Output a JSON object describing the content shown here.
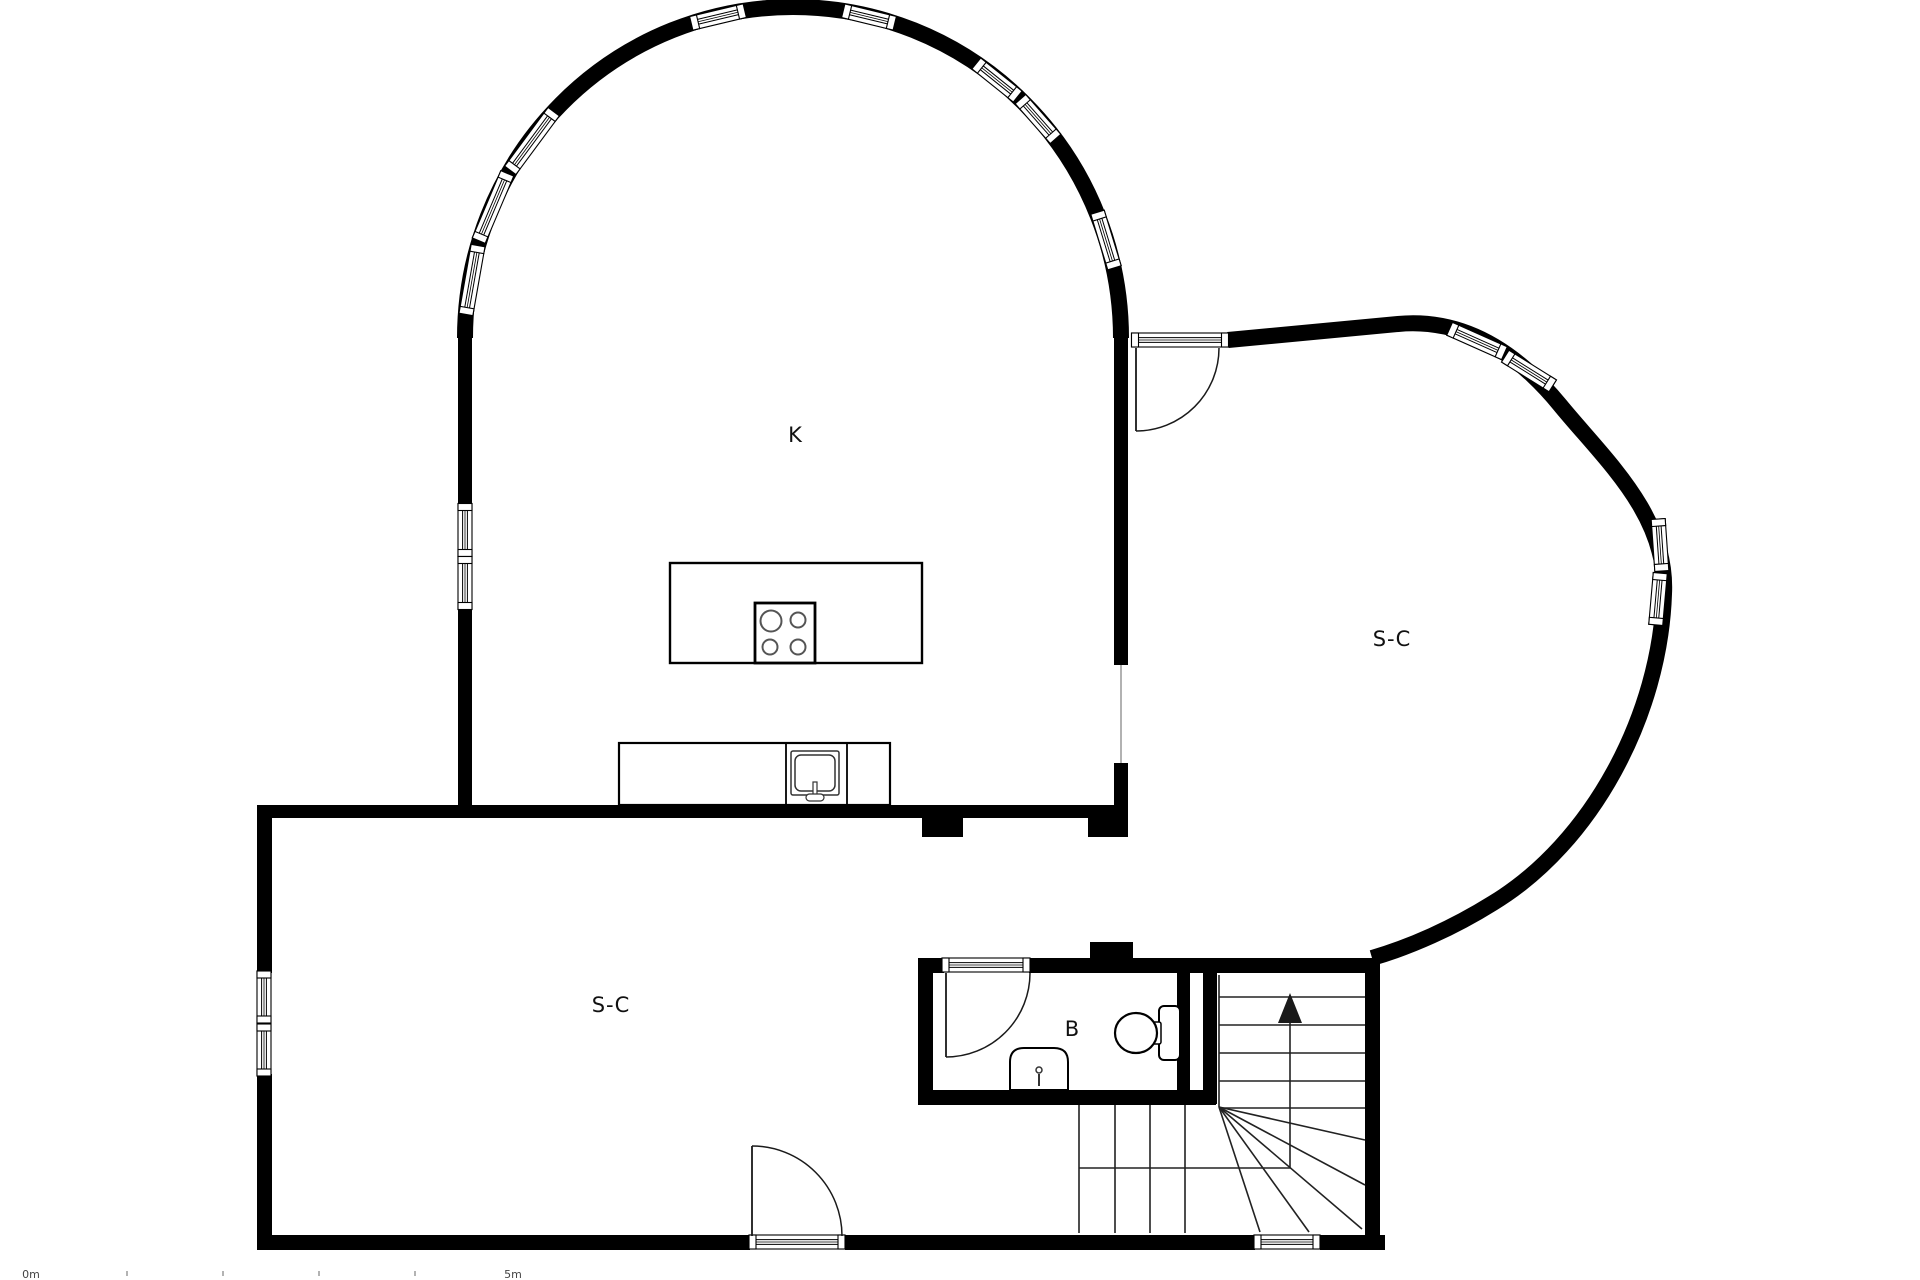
{
  "page": {
    "type": "architectural-floor-plan",
    "background": "#ffffff",
    "ink": "#000000"
  },
  "rooms": [
    {
      "id": "kitchen",
      "label": "K",
      "x": 795,
      "y": 442
    },
    {
      "id": "living-right",
      "label": "S-C",
      "x": 1392,
      "y": 646
    },
    {
      "id": "living-lower",
      "label": "S-C",
      "x": 611,
      "y": 1012
    },
    {
      "id": "bathroom",
      "label": "B",
      "x": 1072,
      "y": 1036
    }
  ],
  "scalebar": {
    "start_label": "0m",
    "end_label": "5m",
    "start_x": 31,
    "end_x": 513,
    "label_y": 1278,
    "tick_xs": [
      126,
      222,
      318,
      414
    ],
    "tick_y": 1271
  },
  "plan": {
    "colors": {
      "wall": "#000000",
      "line": "#1a1a1a",
      "stair": "#222222",
      "light": "#9e9e9e",
      "tick": "#b3b3b3"
    },
    "elements": [
      {
        "t": "path",
        "n": "arch-wall",
        "d": "M 465 338 A 328 331 0 0 1 1121 338",
        "stroke": "#000000",
        "sw": 16,
        "fill": "none"
      },
      {
        "t": "path",
        "n": "sc-curved-wall",
        "d": "M 1228 340 L 1398 324 C 1462 318 1515 350 1560 405 C 1605 460 1668 515 1664 594 C 1660 715 1592 843 1493 903 C 1453 928 1410 947 1372 958",
        "stroke": "#000000",
        "sw": 16,
        "fill": "none"
      },
      {
        "t": "rect",
        "n": "wall-kitchen-bottom",
        "x": 257,
        "y": 805,
        "w": 871,
        "h": 13,
        "fill": "#000000"
      },
      {
        "t": "rect",
        "n": "wall-stub-left",
        "x": 922,
        "y": 818,
        "w": 41,
        "h": 19,
        "fill": "#000000"
      },
      {
        "t": "rect",
        "n": "wall-stub-right",
        "x": 1088,
        "y": 818,
        "w": 40,
        "h": 19,
        "fill": "#000000"
      },
      {
        "t": "rect",
        "n": "wall-k-left-upper",
        "x": 458,
        "y": 331,
        "w": 14,
        "h": 174,
        "fill": "#000000"
      },
      {
        "t": "rect",
        "n": "wall-k-left-lower",
        "x": 458,
        "y": 607,
        "w": 14,
        "h": 211,
        "fill": "#000000"
      },
      {
        "t": "rect",
        "n": "wall-k-right-upper",
        "x": 1114,
        "y": 324,
        "w": 14,
        "h": 341,
        "fill": "#000000"
      },
      {
        "t": "rect",
        "n": "wall-k-right-lower",
        "x": 1114,
        "y": 763,
        "w": 14,
        "h": 74,
        "fill": "#000000"
      },
      {
        "t": "rect",
        "n": "wall-left-upper",
        "x": 257,
        "y": 805,
        "w": 15,
        "h": 168,
        "fill": "#000000"
      },
      {
        "t": "rect",
        "n": "wall-left-lower",
        "x": 257,
        "y": 1074,
        "w": 15,
        "h": 176,
        "fill": "#000000"
      },
      {
        "t": "rect",
        "n": "wall-bottom-a",
        "x": 257,
        "y": 1235,
        "w": 493,
        "h": 15,
        "fill": "#000000"
      },
      {
        "t": "rect",
        "n": "wall-bottom-b",
        "x": 845,
        "y": 1235,
        "w": 410,
        "h": 15,
        "fill": "#000000"
      },
      {
        "t": "rect",
        "n": "wall-bottom-c",
        "x": 1320,
        "y": 1235,
        "w": 65,
        "h": 15,
        "fill": "#000000"
      },
      {
        "t": "rect",
        "n": "wall-bath-top-left",
        "x": 918,
        "y": 958,
        "w": 26,
        "h": 15,
        "fill": "#000000"
      },
      {
        "t": "rect",
        "n": "wall-bath-top-right",
        "x": 1029,
        "y": 958,
        "w": 351,
        "h": 15,
        "fill": "#000000"
      },
      {
        "t": "rect",
        "n": "wall-bath-stub-above",
        "x": 1090,
        "y": 942,
        "w": 43,
        "h": 16,
        "fill": "#000000"
      },
      {
        "t": "rect",
        "n": "wall-bath-left",
        "x": 918,
        "y": 958,
        "w": 15,
        "h": 147,
        "fill": "#000000"
      },
      {
        "t": "rect",
        "n": "wall-bath-right",
        "x": 1177,
        "y": 958,
        "w": 13,
        "h": 147,
        "fill": "#000000"
      },
      {
        "t": "rect",
        "n": "wall-stair-left",
        "x": 1203,
        "y": 973,
        "w": 14,
        "h": 131,
        "fill": "#000000"
      },
      {
        "t": "rect",
        "n": "wall-bath-bottom",
        "x": 918,
        "y": 1090,
        "w": 298,
        "h": 15,
        "fill": "#000000"
      },
      {
        "t": "rect",
        "n": "wall-stair-right",
        "x": 1365,
        "y": 958,
        "w": 15,
        "h": 292,
        "fill": "#000000"
      },
      {
        "t": "line",
        "n": "room-opening-line",
        "x1": 1121,
        "y1": 665,
        "x2": 1121,
        "y2": 763,
        "stroke": "#9e9e9e",
        "sw": 1.6
      },
      {
        "t": "win",
        "n": "window-arch-1",
        "cx": 472,
        "cy": 280,
        "len": 70,
        "rot": 100
      },
      {
        "t": "win",
        "n": "window-arch-2",
        "cx": 493,
        "cy": 207,
        "len": 73,
        "rot": 113
      },
      {
        "t": "win",
        "n": "window-arch-3",
        "cx": 532,
        "cy": 141,
        "len": 73,
        "rot": 126.5
      },
      {
        "t": "win",
        "n": "window-arch-4",
        "cx": 718,
        "cy": 17,
        "len": 55,
        "rot": 166.6
      },
      {
        "t": "win",
        "n": "window-arch-5",
        "cx": 869,
        "cy": 17,
        "len": 53,
        "rot": 13.6
      },
      {
        "t": "win",
        "n": "window-arch-6",
        "cx": 997,
        "cy": 80,
        "len": 53,
        "rot": 38.7
      },
      {
        "t": "win",
        "n": "window-arch-7",
        "cx": 1038,
        "cy": 119,
        "len": 53,
        "rot": 48.6
      },
      {
        "t": "win",
        "n": "window-arch-8",
        "cx": 1106,
        "cy": 240,
        "len": 58,
        "rot": 73
      },
      {
        "t": "win",
        "n": "window-k-left-upper",
        "cx": 465,
        "cy": 530,
        "len": 53,
        "rot": 90
      },
      {
        "t": "win",
        "n": "window-k-left-lower",
        "cx": 465,
        "cy": 583,
        "len": 53,
        "rot": 90
      },
      {
        "t": "win",
        "n": "window-sc-left-upper",
        "cx": 264,
        "cy": 997,
        "len": 52,
        "rot": 90
      },
      {
        "t": "win",
        "n": "window-sc-left-lower",
        "cx": 264,
        "cy": 1050,
        "len": 52,
        "rot": 90
      },
      {
        "t": "win",
        "n": "window-curve-1",
        "cx": 1477,
        "cy": 341,
        "len": 60,
        "rot": 24
      },
      {
        "t": "win",
        "n": "window-curve-2",
        "cx": 1529,
        "cy": 371,
        "len": 56,
        "rot": 32
      },
      {
        "t": "win",
        "n": "window-curve-3",
        "cx": 1660,
        "cy": 545,
        "len": 52,
        "rot": 86
      },
      {
        "t": "win",
        "n": "window-curve-4",
        "cx": 1658,
        "cy": 599,
        "len": 52,
        "rot": 95
      },
      {
        "t": "win",
        "n": "window-bottom-stairs",
        "cx": 1287,
        "cy": 1242,
        "len": 66,
        "rot": 0
      },
      {
        "t": "win",
        "n": "door-threshold-sc",
        "cx": 1180,
        "cy": 340,
        "len": 97,
        "rot": 0
      },
      {
        "t": "win",
        "n": "door-threshold-bath",
        "cx": 986,
        "cy": 965,
        "len": 88,
        "rot": 0
      },
      {
        "t": "win",
        "n": "door-threshold-bottom",
        "cx": 797,
        "cy": 1242,
        "len": 96,
        "rot": 0
      },
      {
        "t": "line",
        "n": "door-leaf-sc",
        "x1": 1136,
        "y1": 348,
        "x2": 1136,
        "y2": 431,
        "stroke": "#1a1a1a",
        "sw": 1.8
      },
      {
        "t": "path",
        "n": "door-swing-arc-sc",
        "d": "M 1136 431 A 83 83 0 0 0 1219 348",
        "stroke": "#1a1a1a",
        "sw": 1.5,
        "fill": "none"
      },
      {
        "t": "line",
        "n": "door-leaf-bath",
        "x1": 946,
        "y1": 973,
        "x2": 946,
        "y2": 1057,
        "stroke": "#1a1a1a",
        "sw": 1.8
      },
      {
        "t": "path",
        "n": "door-swing-arc-bath",
        "d": "M 946 1057 A 84 84 0 0 0 1030 973",
        "stroke": "#1a1a1a",
        "sw": 1.5,
        "fill": "none"
      },
      {
        "t": "line",
        "n": "door-leaf-bottom",
        "x1": 752,
        "y1": 1236,
        "x2": 752,
        "y2": 1146,
        "stroke": "#1a1a1a",
        "sw": 1.8
      },
      {
        "t": "path",
        "n": "door-swing-arc-bottom",
        "d": "M 752 1146 A 90 90 0 0 1 842 1236",
        "stroke": "#1a1a1a",
        "sw": 1.5,
        "fill": "none"
      },
      {
        "t": "line",
        "n": "stair-edge-left",
        "x1": 1079,
        "y1": 1105,
        "x2": 1079,
        "y2": 1233,
        "stroke": "#222222",
        "sw": 1.6
      },
      {
        "t": "line",
        "n": "stair-tread",
        "x1": 1115,
        "y1": 1105,
        "x2": 1115,
        "y2": 1233,
        "stroke": "#222222",
        "sw": 1.6
      },
      {
        "t": "line",
        "n": "stair-tread",
        "x1": 1150,
        "y1": 1105,
        "x2": 1150,
        "y2": 1233,
        "stroke": "#222222",
        "sw": 1.6
      },
      {
        "t": "line",
        "n": "stair-tread",
        "x1": 1185,
        "y1": 1105,
        "x2": 1185,
        "y2": 1233,
        "stroke": "#222222",
        "sw": 1.6
      },
      {
        "t": "line",
        "n": "stair-edge-inner",
        "x1": 1219,
        "y1": 975,
        "x2": 1219,
        "y2": 1107,
        "stroke": "#222222",
        "sw": 1.6
      },
      {
        "t": "line",
        "n": "stair-tread",
        "x1": 1219,
        "y1": 997,
        "x2": 1365,
        "y2": 997,
        "stroke": "#222222",
        "sw": 1.6
      },
      {
        "t": "line",
        "n": "stair-tread",
        "x1": 1219,
        "y1": 1025,
        "x2": 1365,
        "y2": 1025,
        "stroke": "#222222",
        "sw": 1.6
      },
      {
        "t": "line",
        "n": "stair-tread",
        "x1": 1219,
        "y1": 1053,
        "x2": 1365,
        "y2": 1053,
        "stroke": "#222222",
        "sw": 1.6
      },
      {
        "t": "line",
        "n": "stair-tread",
        "x1": 1219,
        "y1": 1081,
        "x2": 1365,
        "y2": 1081,
        "stroke": "#222222",
        "sw": 1.6
      },
      {
        "t": "line",
        "n": "stair-tread",
        "x1": 1219,
        "y1": 1108,
        "x2": 1365,
        "y2": 1108,
        "stroke": "#222222",
        "sw": 1.6
      },
      {
        "t": "line",
        "n": "stair-winder",
        "x1": 1219,
        "y1": 1107,
        "x2": 1260,
        "y2": 1232,
        "stroke": "#222222",
        "sw": 1.6
      },
      {
        "t": "line",
        "n": "stair-winder",
        "x1": 1219,
        "y1": 1107,
        "x2": 1309,
        "y2": 1232,
        "stroke": "#222222",
        "sw": 1.6
      },
      {
        "t": "line",
        "n": "stair-winder",
        "x1": 1219,
        "y1": 1107,
        "x2": 1362,
        "y2": 1229,
        "stroke": "#222222",
        "sw": 1.6
      },
      {
        "t": "line",
        "n": "stair-winder",
        "x1": 1219,
        "y1": 1107,
        "x2": 1365,
        "y2": 1185,
        "stroke": "#222222",
        "sw": 1.6
      },
      {
        "t": "line",
        "n": "stair-winder",
        "x1": 1219,
        "y1": 1107,
        "x2": 1365,
        "y2": 1140,
        "stroke": "#222222",
        "sw": 1.6
      },
      {
        "t": "polyline",
        "n": "stair-walk-line",
        "points": "1079,1168 1290,1168 1290,1012",
        "stroke": "#222222",
        "sw": 1.6,
        "fill": "none"
      },
      {
        "t": "polygon",
        "n": "stair-up-arrow",
        "points": "1290,993 1278,1023 1302,1023",
        "fill": "#1a1a1a"
      },
      {
        "t": "rect",
        "n": "kitchen-island",
        "x": 670,
        "y": 563,
        "w": 252,
        "h": 100,
        "fill": "#ffffff",
        "stroke": "#000000",
        "sw": 2.4
      },
      {
        "t": "rect",
        "n": "stove",
        "x": 755,
        "y": 603,
        "w": 60,
        "h": 60,
        "fill": "#ffffff",
        "stroke": "#000000",
        "sw": 2.8
      },
      {
        "t": "circle",
        "n": "stove-burner",
        "cx": 771,
        "cy": 621,
        "r": 10.5,
        "fill": "#ffffff",
        "stroke": "#555555",
        "sw": 2
      },
      {
        "t": "circle",
        "n": "stove-burner",
        "cx": 798,
        "cy": 620,
        "r": 7.5,
        "fill": "#ffffff",
        "stroke": "#555555",
        "sw": 2
      },
      {
        "t": "circle",
        "n": "stove-burner",
        "cx": 770,
        "cy": 647,
        "r": 7.5,
        "fill": "#ffffff",
        "stroke": "#555555",
        "sw": 2
      },
      {
        "t": "circle",
        "n": "stove-burner",
        "cx": 798,
        "cy": 647,
        "r": 7.5,
        "fill": "#ffffff",
        "stroke": "#555555",
        "sw": 2
      },
      {
        "t": "rect",
        "n": "kitchen-counter",
        "x": 619,
        "y": 743,
        "w": 271,
        "h": 62,
        "fill": "#ffffff",
        "stroke": "#000000",
        "sw": 2.2
      },
      {
        "t": "line",
        "n": "counter-divider",
        "x1": 786,
        "y1": 743,
        "x2": 786,
        "y2": 805,
        "stroke": "#000000",
        "sw": 1.8
      },
      {
        "t": "line",
        "n": "counter-divider",
        "x1": 847,
        "y1": 743,
        "x2": 847,
        "y2": 805,
        "stroke": "#000000",
        "sw": 1.8
      },
      {
        "t": "rect",
        "n": "kitchen-sink-outer",
        "x": 791,
        "y": 751,
        "w": 48,
        "h": 44,
        "rx": 2,
        "fill": "#ffffff",
        "stroke": "#333333",
        "sw": 1.5
      },
      {
        "t": "rect",
        "n": "kitchen-sink-basin",
        "x": 795,
        "y": 755,
        "w": 40,
        "h": 36,
        "rx": 6,
        "fill": "#ffffff",
        "stroke": "#333333",
        "sw": 1.5
      },
      {
        "t": "rect",
        "n": "kitchen-faucet-stem",
        "x": 813,
        "y": 782,
        "w": 4,
        "h": 13,
        "fill": "#ffffff",
        "stroke": "#333333",
        "sw": 1.2
      },
      {
        "t": "rect",
        "n": "kitchen-faucet-base",
        "x": 806,
        "y": 794,
        "w": 18,
        "h": 7,
        "rx": 3.5,
        "fill": "#ffffff",
        "stroke": "#333333",
        "sw": 1.2
      },
      {
        "t": "path",
        "n": "bathroom-sink",
        "d": "M 1010 1090 L 1010 1062 Q 1010 1048 1024 1048 L 1054 1048 Q 1068 1048 1068 1062 L 1068 1090 Z",
        "fill": "#ffffff",
        "stroke": "#000000",
        "sw": 2
      },
      {
        "t": "circle",
        "n": "bathroom-faucet-dot",
        "cx": 1039,
        "cy": 1070,
        "r": 3,
        "fill": "#ffffff",
        "stroke": "#333333",
        "sw": 1.5
      },
      {
        "t": "line",
        "n": "bathroom-faucet-stem",
        "x1": 1039,
        "y1": 1074,
        "x2": 1039,
        "y2": 1086,
        "stroke": "#333333",
        "sw": 2
      },
      {
        "t": "rect",
        "n": "toilet-tank",
        "x": 1159,
        "y": 1006,
        "w": 21,
        "h": 54,
        "rx": 5,
        "fill": "#ffffff",
        "stroke": "#000000",
        "sw": 2
      },
      {
        "t": "rect",
        "n": "toilet-connector",
        "x": 1153,
        "y": 1022,
        "w": 8,
        "h": 22,
        "rx": 2,
        "fill": "#ffffff",
        "stroke": "#000000",
        "sw": 1.5
      },
      {
        "t": "ellipse",
        "n": "toilet-bowl",
        "cx": 1136,
        "cy": 1033,
        "rx": 21,
        "ry": 20,
        "fill": "#ffffff",
        "stroke": "#000000",
        "sw": 2.2
      },
      {
        "t": "text",
        "n": "room-label-kitchen",
        "bind": "rooms.0.label",
        "x": 795,
        "y": 442,
        "size": 21,
        "fill": "#111111",
        "ls": 0
      },
      {
        "t": "text",
        "n": "room-label-living-right",
        "bind": "rooms.1.label",
        "x": 1392,
        "y": 646,
        "size": 21,
        "fill": "#111111",
        "ls": 1
      },
      {
        "t": "text",
        "n": "room-label-living-lower",
        "bind": "rooms.2.label",
        "x": 611,
        "y": 1012,
        "size": 21,
        "fill": "#111111",
        "ls": 1
      },
      {
        "t": "text",
        "n": "room-label-bathroom",
        "bind": "rooms.3.label",
        "x": 1072,
        "y": 1036,
        "size": 21,
        "fill": "#111111",
        "ls": 0
      },
      {
        "t": "rect",
        "n": "scale-tick",
        "x": 126,
        "y": 1271,
        "w": 2,
        "h": 5,
        "fill": "#b3b3b3"
      },
      {
        "t": "rect",
        "n": "scale-tick",
        "x": 222,
        "y": 1271,
        "w": 2,
        "h": 5,
        "fill": "#b3b3b3"
      },
      {
        "t": "rect",
        "n": "scale-tick",
        "x": 318,
        "y": 1271,
        "w": 2,
        "h": 5,
        "fill": "#b3b3b3"
      },
      {
        "t": "rect",
        "n": "scale-tick",
        "x": 414,
        "y": 1271,
        "w": 2,
        "h": 5,
        "fill": "#b3b3b3"
      },
      {
        "t": "text",
        "n": "scale-label-0m",
        "bind": "scalebar.start_label",
        "x": 31,
        "y": 1278,
        "size": 11,
        "fill": "#444444",
        "ls": 0
      },
      {
        "t": "text",
        "n": "scale-label-5m",
        "bind": "scalebar.end_label",
        "x": 513,
        "y": 1278,
        "size": 11,
        "fill": "#444444",
        "ls": 0
      }
    ]
  }
}
